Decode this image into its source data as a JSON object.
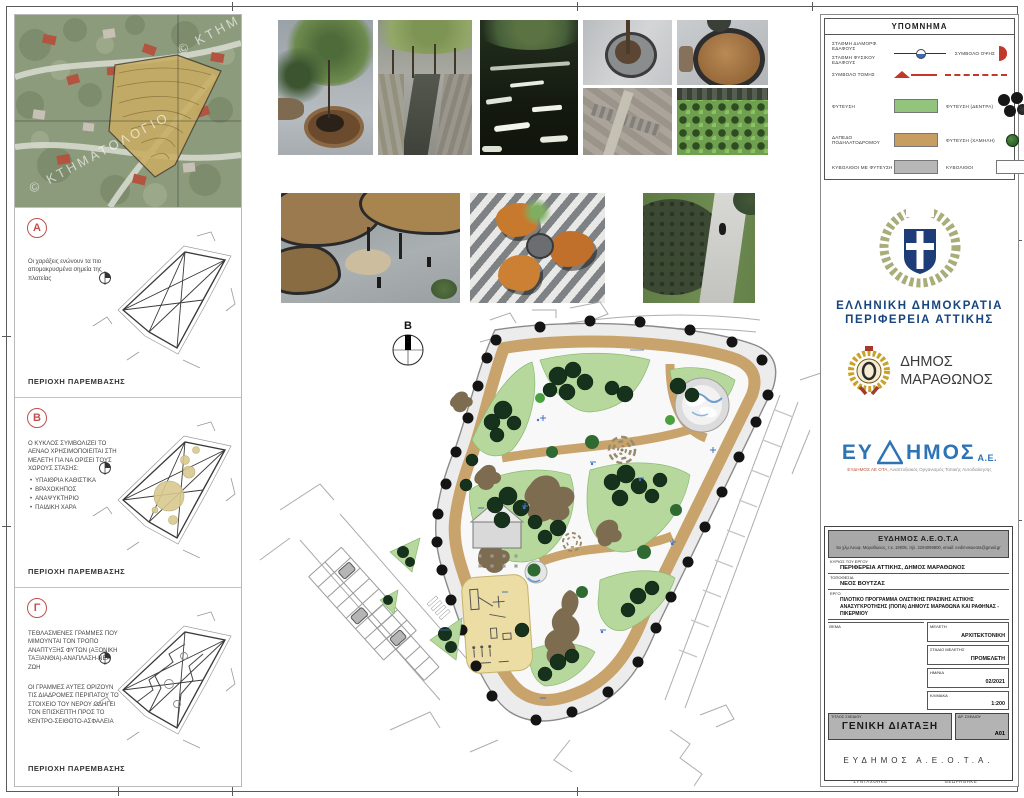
{
  "colors": {
    "accent_red": "#c0392b",
    "legend_green": "#93c47d",
    "legend_tan": "#c79e62",
    "legend_gray": "#b7b7b7",
    "bike_path_tan": "#c8a36b",
    "planting_green": "#b6d89c",
    "republic_blue": "#17457e",
    "evdimos_blue": "#2e74b5",
    "annotation_blue": "#4472c4"
  },
  "aerial": {
    "watermark": "© ΚΤΗΜΑΤΟΛΟΓΙΟ",
    "watermark_partial": "© ΚΤΗΜ"
  },
  "panels": {
    "a": {
      "letter": "Α",
      "body": "Οι χαράξεις ενώνουν τα πιο απομακρυσμένα σημεία της πλατείας",
      "caption": "ΠΕΡΙΟΧΗ ΠΑΡΕΜΒΑΣΗΣ"
    },
    "b": {
      "letter": "Β",
      "intro": "Ο ΚΥΚΛΟΣ ΣΥΜΒΟΛΙΖΕΙ ΤΟ ΑΕΝΑΟ ΧΡΗΣΙΜΟΠΟΙΕΙΤΑΙ ΣΤΗ ΜΕΛΕΤΗ ΓΙΑ ΝΑ ΟΡΙΣΕΙ ΤΟΥΣ ΧΩΡΟΥΣ ΣΤΑΣΗΣ:",
      "bullets": [
        "ΥΠΑΙΘΡΙΑ ΚΑΘΙΣΤΙΚΑ",
        "ΒΡΑΧΟΚΗΠΟΣ",
        "ΑΝΑΨΥΚΤΗΡΙΟ",
        "ΠΑΙΔΙΚΗ ΧΑΡΑ"
      ],
      "caption": "ΠΕΡΙΟΧΗ ΠΑΡΕΜΒΑΣΗΣ"
    },
    "c": {
      "letter": "Γ",
      "body1": "ΤΕΘΛΑΣΜΕΝΕΣ ΓΡΑΜΜΕΣ ΠΟΥ ΜΙΜΟΥΝΤΑΙ ΤΟΝ ΤΡΟΠΟ ΑΝΑΠΤΥΞΗΣ ΦΥΤΩΝ (ΑΞΟΝΙΚΗ ΤΑΞΙΑΝΘΙΑ)-ΑΝΑΠΛΑΣΗ-ΝΕΑ ΖΩΗ",
      "body2": "ΟΙ ΓΡΑΜΜΕΣ ΑΥΤΕΣ ΟΡΙΖΟΥΝ ΤΙΣ ΔΙΑΔΡΟΜΕΣ ΠΕΡΙΠΑΤΟΥ ΤΟ ΣΤΟΙΧΕΙΟ ΤΟΥ ΝΕΡΟΥ ΟΔΗΓΕΙ ΤΟΝ ΕΠΙΣΚΕΠΤΗ ΠΡΟΣ ΤΟ ΚΕΝΤΡΟ-ΣΕΙΘΟΤΟ-ΑΣΦΑΛΕΙΑ",
      "caption": "ΠΕΡΙΟΧΗ ΠΑΡΕΜΒΑΣΗΣ"
    }
  },
  "legend": {
    "title": "ΥΠΟΜΝΗΜΑ",
    "level_formed": "ΣΤΑΘΜΗ ΔΙΑΜΟΡΦ. ΕΔΑΦΟΥΣ",
    "level_natural": "ΣΤΑΘΜΗ ΦΥΣΙΚΟΥ ΕΔΑΦΟΥΣ",
    "view_symbol": "ΣΥΜΒΟΛΟ ΟΨΗΣ",
    "section_symbol": "ΣΥΜΒΟΛΟ ΤΟΜΗΣ",
    "planting": "ΦΥΤΕΥΣΗ",
    "planting_trees": "ΦΥΤΕΥΣΗ (ΔΕΝΤΡΑ)",
    "bike_path": "ΔΑΠΕΔΟ ΠΟΔΗΛΑΤΟΔΡΟΜΟΥ",
    "planting_low": "ΦΥΤΕΥΣΗ (ΧΑΜΗΛΗ)",
    "pavers_planted": "ΚΥΒΟΛΙΘΟΙ ΜΕ ΦΥΤΕΥΣΗ",
    "pavers": "ΚΥΒΟΛΙΘΟΙ"
  },
  "plan": {
    "north": "Β"
  },
  "branding": {
    "republic_line1": "ΕΛΛΗΝΙΚΗ ΔΗΜΟΚΡΑΤΙΑ",
    "republic_line2": "ΠΕΡΙΦΕΡΕΙΑ ΑΤΤΙΚΗΣ",
    "municipality_line1": "ΔΗΜΟΣ",
    "municipality_line2": "ΜΑΡΑΘΩΝΟΣ",
    "evdimos_eu": "ΕΥ",
    "evdimos_rest": "ΗΜΟΣ",
    "evdimos_ae": "Α.Ε.",
    "evdimos_sub1": "ΕΥΔΗΜΟΣ ΑΕ ΟΤΑ,",
    "evdimos_sub2": " Αναπτυξιακός Οργανισμός Τοπικής Αυτοδιοίκησης"
  },
  "titleblock": {
    "company": "ΕΥΔΗΜΟΣ Α.Ε.Ο.Τ.Α",
    "address": "5ο χλμ Λεωφ. Μαραθώνος, τ.κ. 19005, τηλ. 2294069800, email: evdimosaeota@gmail.gr",
    "owner_label": "ΚΥΡΙΟΣ ΤΟΥ ΕΡΓΟΥ",
    "owner": "ΠΕΡΙΦΕΡΕΙΑ ΑΤΤΙΚΗΣ, ΔΗΜΟΣ ΜΑΡΑΘΩΝΟΣ",
    "location_label": "ΤΟΠΟΘΕΣΙΑ",
    "location": "ΝΕΟΣ ΒΟΥΤΖΑΣ",
    "project_label": "ΕΡΓΟ",
    "project": "ΠΙΛΟΤΙΚΟ ΠΡΟΓΡΑΜΜΑ ΟΛΙΣΤΙΚΗΣ ΠΡΑΣΙΝΗΣ ΑΣΤΙΚΗΣ ΑΝΑΣΥΓΚΡΟΤΗΣΗΣ (ΠΟΠΑ) ΔΗΜΟΥΣ ΜΑΡΑΘΩΝΑ ΚΑΙ ΡΑΦΗΝΑΣ - ΠΙΚΕΡΜΙΟΥ",
    "subject_label": "ΘΕΜΑ",
    "study_label": "ΜΕΛΕΤΗ",
    "study": "ΑΡΧΙΤΕΚΤΟΝΙΚΗ",
    "stage_label": "ΣΤΑΔΙΟ ΜΕΛΕΤΗΣ",
    "stage": "ΠΡΟΜΕΛΕΤΗ",
    "date_label": "ΗΜ/ΝΙΑ",
    "date": "02/2021",
    "scale_label": "ΚΛΙΜΑΚΑ",
    "scale": "1:200",
    "title_label": "ΤΙΤΛΟΣ ΣΧΕΔΙΟΥ",
    "title": "ΓΕΝΙΚΗ ΔΙΑΤΑΞΗ",
    "number_label": "ΑΡ. ΣΧΕΔΙΟΥ",
    "number": "Α01",
    "firm": "ΕΥΔΗΜΟΣ Α.Ε.Ο.Τ.Α.",
    "drafted_label": "ΣΥΝΤΑΧΘΗΚΕ",
    "drafted": "ΠΑΝΑΓΙΩΤΗΣ ΜΑΡΚΟΥ",
    "checked_label": "ΘΕΩΡΗΘΗΚΕ",
    "checked": "ΓΕΩΡΓΙΟΣ ΚΑΡΑΜΕΣΙΝΗΣ"
  }
}
